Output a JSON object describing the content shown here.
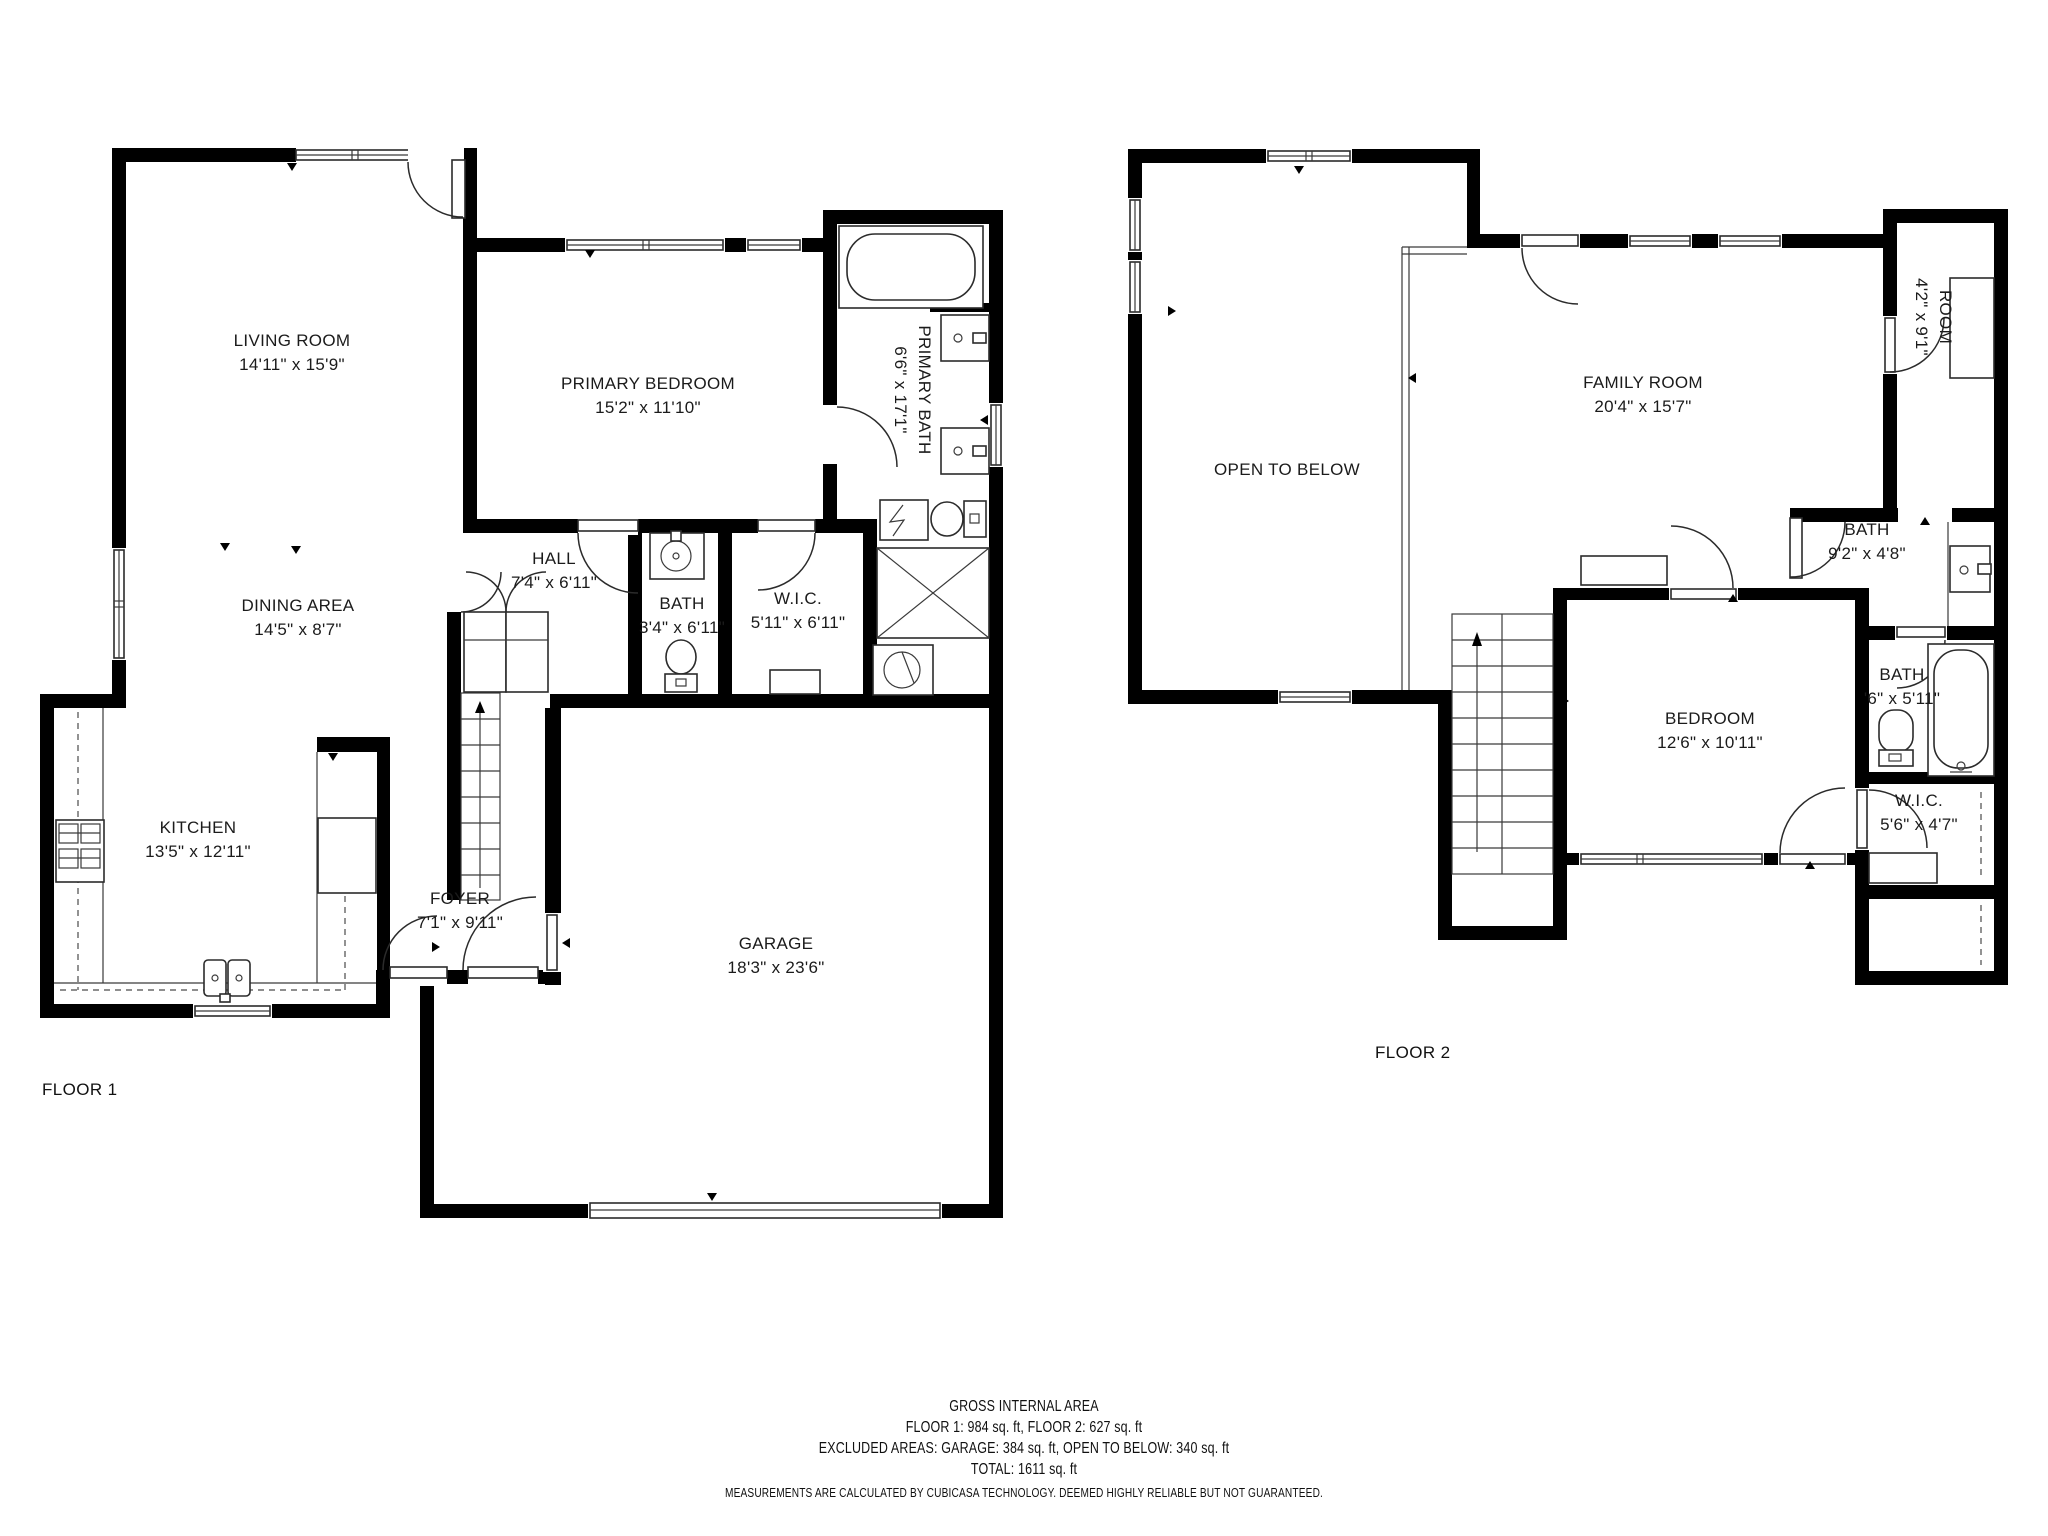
{
  "floors": [
    {
      "name": "FLOOR 1",
      "rooms": [
        {
          "label": "LIVING ROOM",
          "dims": "14'11\" x 15'9\""
        },
        {
          "label": "DINING AREA",
          "dims": "14'5\" x 8'7\""
        },
        {
          "label": "KITCHEN",
          "dims": "13'5\" x 12'11\""
        },
        {
          "label": "FOYER",
          "dims": "7'1\" x 9'11\""
        },
        {
          "label": "GARAGE",
          "dims": "18'3\" x 23'6\""
        },
        {
          "label": "PRIMARY BEDROOM",
          "dims": "15'2\" x 11'10\""
        },
        {
          "label": "PRIMARY BATH",
          "dims": "6'6\" x 17'1\""
        },
        {
          "label": "HALL",
          "dims": "7'4\" x 6'11\""
        },
        {
          "label": "BATH",
          "dims": "3'4\" x 6'11\""
        },
        {
          "label": "W.I.C.",
          "dims": "5'11\" x 6'11\""
        }
      ]
    },
    {
      "name": "FLOOR 2",
      "rooms": [
        {
          "label": "FAMILY ROOM",
          "dims": "20'4\" x 15'7\""
        },
        {
          "label": "OPEN TO BELOW",
          "dims": ""
        },
        {
          "label": "ROOM",
          "dims": "4'2\" x 9'1\""
        },
        {
          "label": "BATH",
          "dims": "9'2\" x 4'8\""
        },
        {
          "label": "BEDROOM",
          "dims": "12'6\" x 10'11\""
        },
        {
          "label": "BATH",
          "dims": "'6\" x 5'11\""
        },
        {
          "label": "W.I.C.",
          "dims": "5'6\" x 4'7\""
        }
      ]
    }
  ],
  "footer": {
    "title": "GROSS INTERNAL AREA",
    "line1": "FLOOR 1: 984 sq. ft, FLOOR 2: 627 sq. ft",
    "line2": "EXCLUDED AREAS: GARAGE: 384 sq. ft, OPEN TO BELOW: 340 sq. ft",
    "line3": "TOTAL: 1611 sq. ft",
    "disclaimer": "MEASUREMENTS ARE CALCULATED BY CUBICASA TECHNOLOGY. DEEMED HIGHLY RELIABLE BUT NOT GUARANTEED."
  },
  "colors": {
    "wall": "#000000",
    "background": "#ffffff",
    "fixture_stroke": "#2b2b2b",
    "text": "#1b1b1b"
  }
}
